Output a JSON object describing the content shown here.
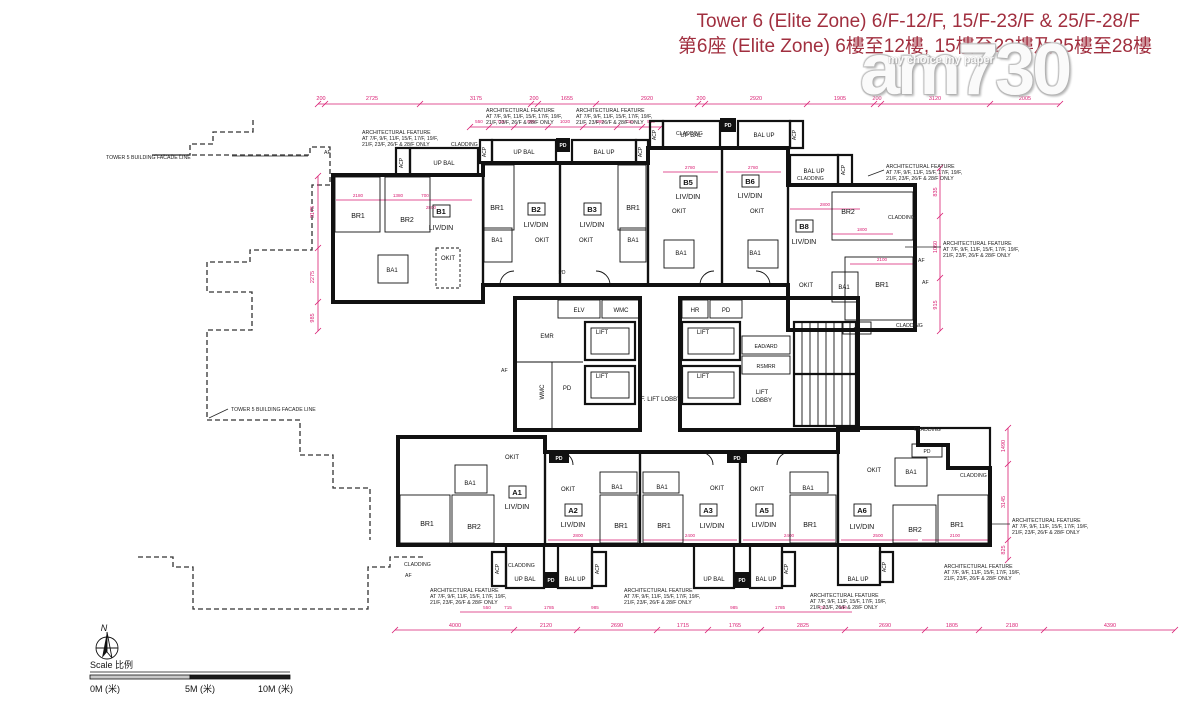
{
  "title": {
    "line1": "Tower 6 (Elite Zone) 6/F-12/F, 15/F-23/F & 25/F-28/F",
    "line2": "第6座 (Elite Zone) 6樓至12樓, 15樓至23樓及25樓至28樓"
  },
  "watermark": {
    "brand": "am730",
    "tagline": "my choice my paper"
  },
  "colors": {
    "dimension_magenta": "#d91d72",
    "title_red": "#a12f3f",
    "wall_black": "#111111",
    "unit_cream": "#f7eedd",
    "unit_peach": "#f8ddbd",
    "unit_pink": "#f4dedd",
    "unit_rose": "#eab7b2"
  },
  "labels": {
    "cladding": "CLADDING",
    "acp": "ACP",
    "af": "AF",
    "pd": "PD",
    "up_bal": "UP BAL",
    "bal_up": "BAL UP",
    "facade_line": "TOWER 5 BUILDING FACADE LINE",
    "north": "N"
  },
  "notes": {
    "arch_line1": "ARCHITECTURAL FEATURE",
    "arch_line2": "AT 7/F, 9/F, 11/F, 15/F, 17/F, 19/F,",
    "arch_line3": "21/F, 23/F, 26/F & 28/F ONLY"
  },
  "core": {
    "emr": "EMR",
    "elv": "ELV",
    "wmc": "WMC",
    "lift": "LIFT",
    "f_lift_lobby": "F. LIFT LOBBY",
    "hr": "HR",
    "ead_ard": "EAD/ARD",
    "rsmrr": "RSMRR",
    "lift_lobby_1": "LIFT",
    "lift_lobby_2": "LOBBY"
  },
  "rooms": {
    "living": "LIV/DIN",
    "br1": "BR1",
    "br2": "BR2",
    "bath": "BA1",
    "kitchen": "OKIT"
  },
  "units": {
    "b1": "B1",
    "b2": "B2",
    "b3": "B3",
    "b5": "B5",
    "b6": "B6",
    "b8": "B8",
    "a1": "A1",
    "a2": "A2",
    "a3": "A3",
    "a5": "A5",
    "a6": "A6"
  },
  "scalebar": {
    "title": "Scale  比例",
    "m0": "0M (米)",
    "m5": "5M (米)",
    "m10": "10M (米)"
  },
  "dims": {
    "top": [
      "200",
      "2725",
      "3175",
      "200",
      "1655",
      "2920",
      "200",
      "2920",
      "1905",
      "200",
      "3120",
      "2005"
    ],
    "bottom": [
      "4000",
      "2120",
      "2690",
      "1715",
      "1765",
      "2825",
      "2690",
      "1805",
      "2180",
      "4390"
    ],
    "left": [
      "3175",
      "2275",
      "985"
    ],
    "right_upper": [
      "835",
      "1060",
      "915"
    ],
    "right_lower": [
      "1490",
      "3145",
      "825"
    ],
    "inner_top": [
      "550",
      "715",
      "985",
      "1020",
      "985",
      "715",
      "550"
    ],
    "inner_bottom": [
      "550",
      "715",
      "1785",
      "985",
      "985",
      "1785",
      "715",
      "550"
    ],
    "interior": [
      "2180",
      "1380",
      "700",
      "2800",
      "2780",
      "2780",
      "2800",
      "1800",
      "2100",
      "2800",
      "2400",
      "2400",
      "2500",
      "2100"
    ]
  }
}
